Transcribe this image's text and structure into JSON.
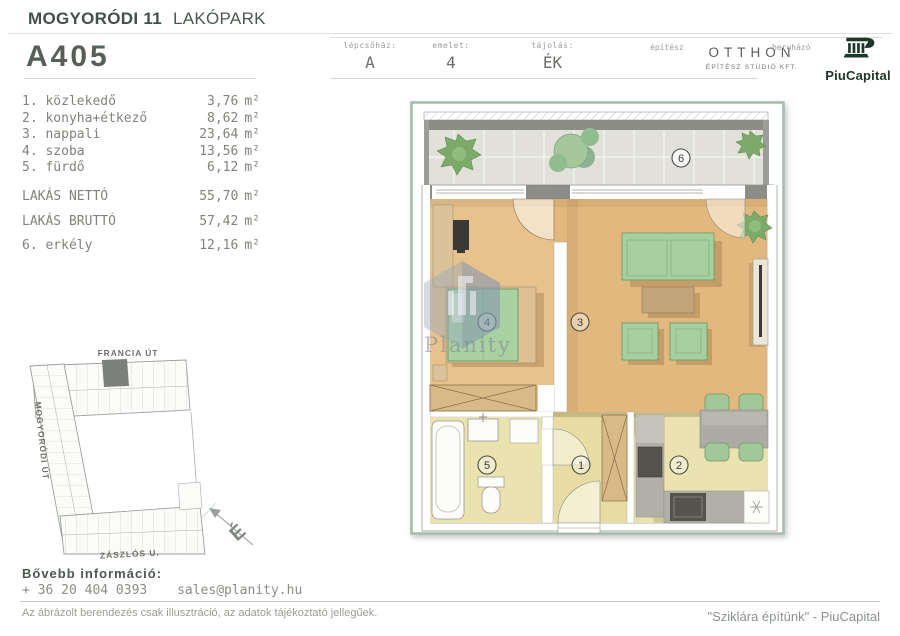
{
  "colors": {
    "brand_green": "#1d3829",
    "frame_green": "#a8bcb0",
    "wood_floor": "#e7c28d",
    "khaki_floor": "#eae2af",
    "furniture_green": "#a8cf9f",
    "wall_dark": "#8d8d87",
    "text_dark": "#46504a",
    "text_gray": "#82827c"
  },
  "header": {
    "title_bold": "MOGYORÓDI 11",
    "title_rest": "LAKÓPARK",
    "apartment_code": "A405",
    "fields": [
      {
        "label": "lépcsőház:",
        "value": "A"
      },
      {
        "label": "emelet:",
        "value": "4"
      },
      {
        "label": "tájolás:",
        "value": "ÉK"
      }
    ],
    "architect_label": "építész",
    "architect_name": "OTTHON",
    "architect_sub": "ÉPÍTÉSZ STÚDIÓ KFT.",
    "developer_label": "beruházó",
    "developer_name": "PiuCapital"
  },
  "rooms": {
    "unit": "m²",
    "items": [
      {
        "label": "1. közlekedő",
        "value": "3,76"
      },
      {
        "label": "2. konyha+étkező",
        "value": "8,62"
      },
      {
        "label": "3. nappali",
        "value": "23,64"
      },
      {
        "label": "4. szoba",
        "value": "13,56"
      },
      {
        "label": "5. fürdő",
        "value": "6,12"
      }
    ],
    "totals": [
      {
        "label": "LAKÁS NETTÓ",
        "value": "55,70"
      },
      {
        "label": "LAKÁS BRUTTÓ",
        "value": "57,42"
      }
    ],
    "extra": {
      "label": "6. erkély",
      "value": "12,16"
    }
  },
  "site_plan": {
    "street_top": "FRANCIA ÚT",
    "street_left": "MOGYORÓDI ÚT",
    "street_bottom": "ZÁSZLÓS U.",
    "compass": "É"
  },
  "floor_plan": {
    "room_numbers": [
      "1",
      "2",
      "3",
      "4",
      "5",
      "6"
    ],
    "watermark": "Planity"
  },
  "footer": {
    "info_label": "Bővebb információ:",
    "phone": "+ 36 20 404 0393",
    "email": "sales@planity.hu",
    "disclaimer": "Az ábrázolt berendezés csak illusztráció, az adatok tájékoztató jellegűek.",
    "tagline": "\"Sziklára építünk\" - PiuCapital"
  }
}
